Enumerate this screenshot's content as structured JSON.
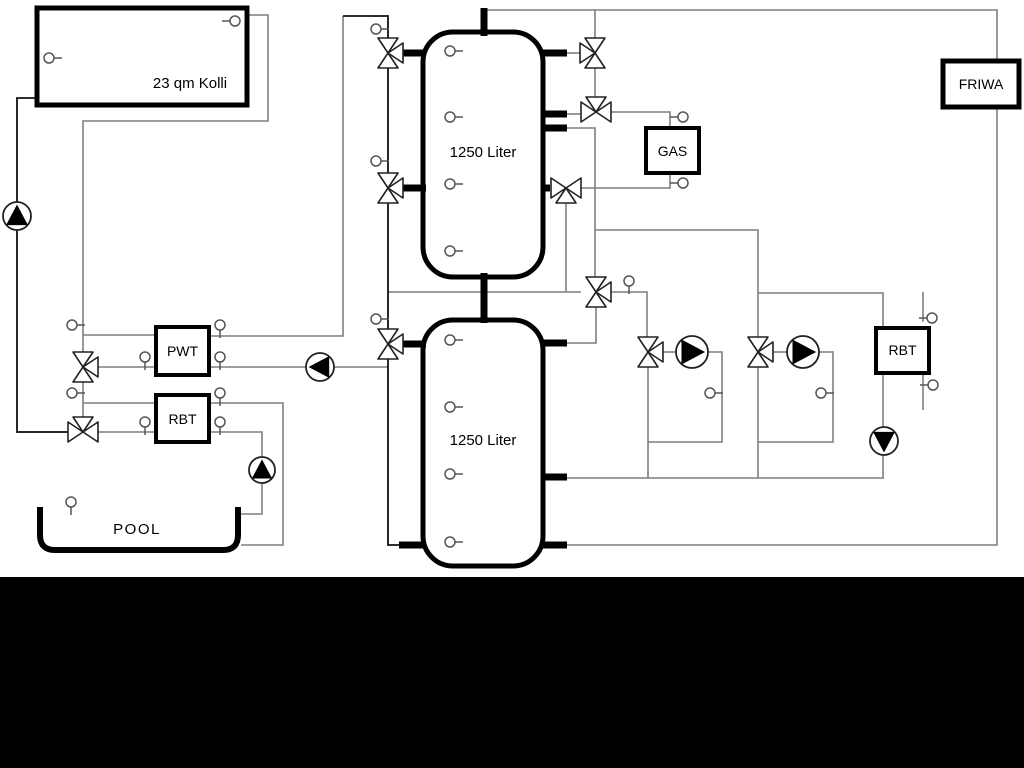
{
  "labels": {
    "collector": "23 qm Kolli",
    "tank_top": "1250 Liter",
    "tank_bottom": "1250 Liter",
    "gas": "GAS",
    "friwa": "FRIWA",
    "pwt": "PWT",
    "rbt_left": "RBT",
    "rbt_right": "RBT",
    "pool": "POOL"
  },
  "colors": {
    "pipe_gray": "#7f7f7f",
    "pipe_black": "#111111",
    "component_stroke": "#000000",
    "background": "#ffffff",
    "bottom_bar": "#000000"
  }
}
